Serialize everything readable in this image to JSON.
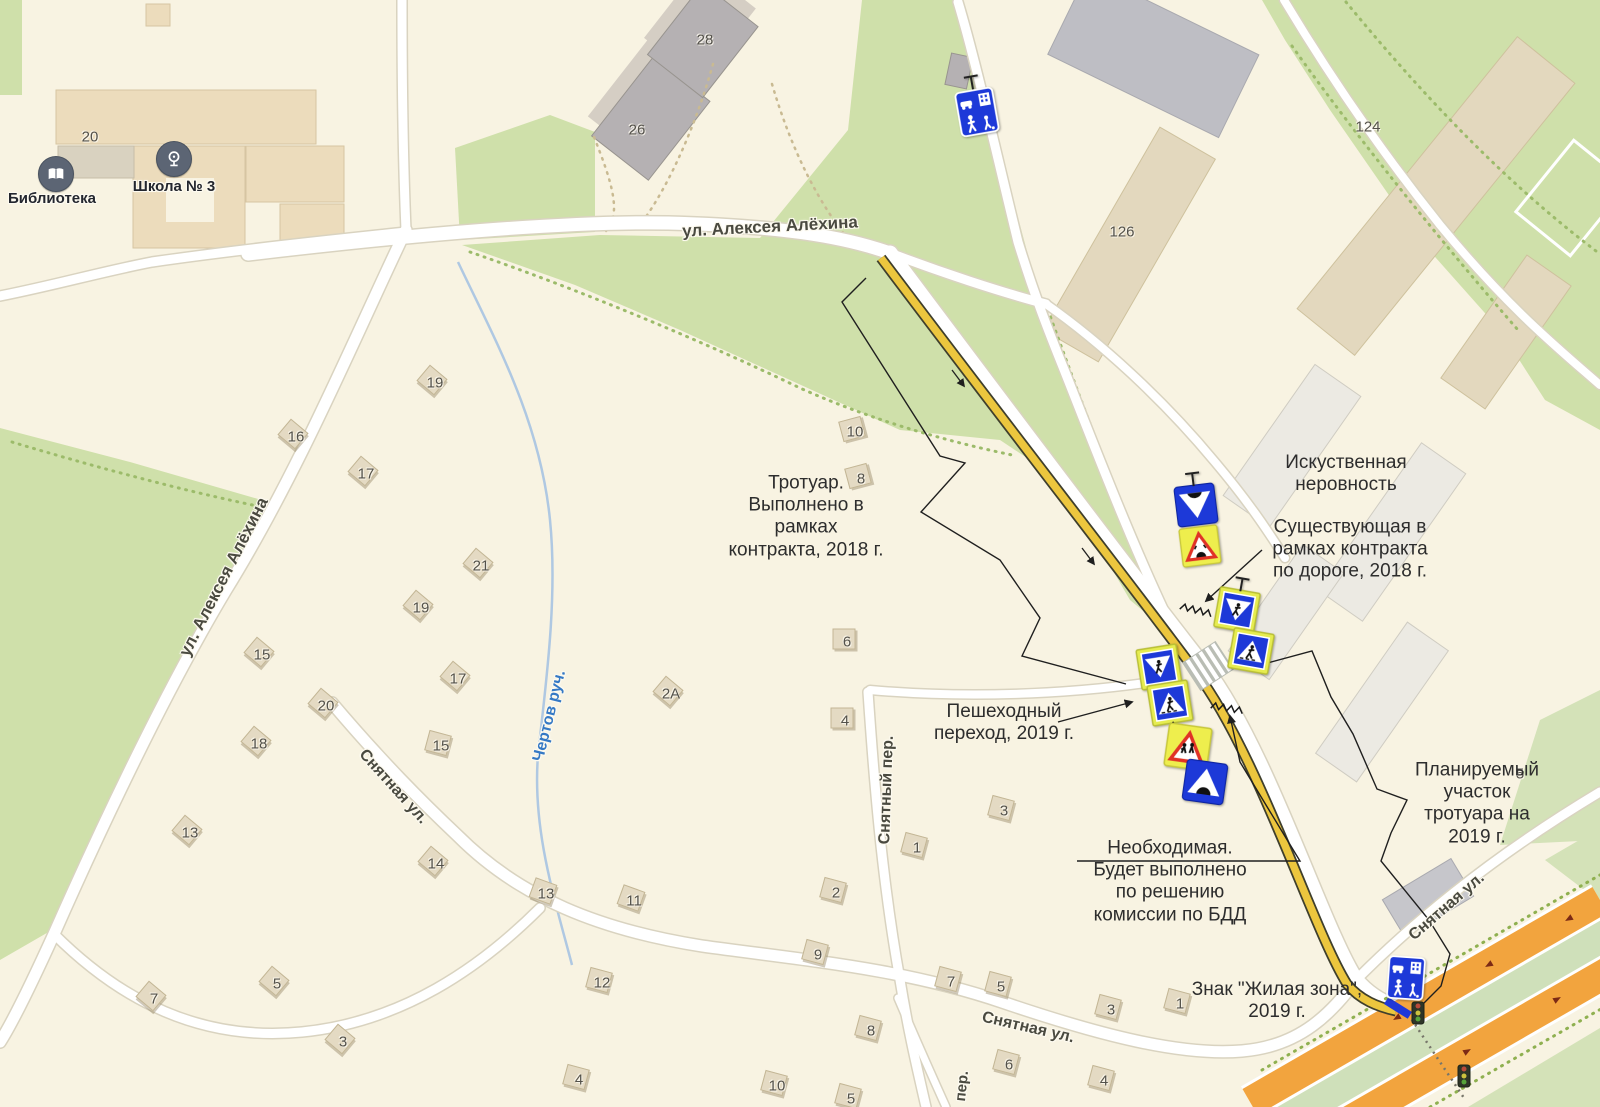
{
  "map": {
    "colors": {
      "background": "#f8f3e2",
      "park_green": "#cfe0aa",
      "road_white": "#ffffff",
      "sidewalk_yellow": "#ecc63e",
      "highway_orange": "#f2a43e",
      "sign_blue": "#1d39d8",
      "sign_frame_yellow": "#e6ec50",
      "warning_yellow": "#eeee4d",
      "warning_red": "#e03226",
      "water_blue": "#3579c5"
    },
    "poi": {
      "library": {
        "label": "Библиотека"
      },
      "school": {
        "label": "Школа № 3"
      }
    },
    "street_labels": [
      {
        "t": "ул. Алексея Алёхина",
        "x": 770,
        "y": 227,
        "r": -3,
        "s": 17
      },
      {
        "t": "ул. Алексея Алёхина",
        "x": 224,
        "y": 577,
        "r": -63,
        "s": 17
      },
      {
        "t": "Снятная ул.",
        "x": 393,
        "y": 787,
        "r": 48,
        "s": 16
      },
      {
        "t": "Снятный пер.",
        "x": 887,
        "y": 790,
        "r": -88,
        "s": 16
      },
      {
        "t": "Снятная ул.",
        "x": 1028,
        "y": 1028,
        "r": 13,
        "s": 16
      },
      {
        "t": "Снятная ул.",
        "x": 1447,
        "y": 907,
        "r": -41,
        "s": 16
      },
      {
        "t": "Чертов руч.",
        "x": 550,
        "y": 716,
        "r": -76,
        "s": 16,
        "c": "#3579c5"
      },
      {
        "t": "пер.",
        "x": 962,
        "y": 1086,
        "r": -84,
        "s": 15
      }
    ],
    "building_numbers": [
      {
        "n": "20",
        "x": 90,
        "y": 137,
        "house": false,
        "rot": 0
      },
      {
        "n": "28",
        "x": 705,
        "y": 40,
        "house": false,
        "rot": 0
      },
      {
        "n": "26",
        "x": 637,
        "y": 130,
        "house": false,
        "rot": 0
      },
      {
        "n": "124",
        "x": 1368,
        "y": 127,
        "house": false,
        "rot": 0
      },
      {
        "n": "126",
        "x": 1122,
        "y": 232,
        "house": false,
        "rot": 0
      },
      {
        "n": "5",
        "x": 1520,
        "y": 774,
        "house": false,
        "rot": 0
      },
      {
        "n": "19",
        "x": 435,
        "y": 383,
        "house": true,
        "rot": 40
      },
      {
        "n": "16",
        "x": 296,
        "y": 437,
        "house": true,
        "rot": 40
      },
      {
        "n": "17",
        "x": 366,
        "y": 474,
        "house": true,
        "rot": 40
      },
      {
        "n": "10",
        "x": 855,
        "y": 432,
        "house": true,
        "rot": -15
      },
      {
        "n": "8",
        "x": 861,
        "y": 479,
        "house": true,
        "rot": -15
      },
      {
        "n": "21",
        "x": 481,
        "y": 566,
        "house": true,
        "rot": 40
      },
      {
        "n": "19",
        "x": 421,
        "y": 608,
        "house": true,
        "rot": 40
      },
      {
        "n": "15",
        "x": 262,
        "y": 655,
        "house": true,
        "rot": 40
      },
      {
        "n": "17",
        "x": 458,
        "y": 679,
        "house": true,
        "rot": 40
      },
      {
        "n": "6",
        "x": 847,
        "y": 642,
        "house": true,
        "rot": 0
      },
      {
        "n": "20",
        "x": 326,
        "y": 706,
        "house": true,
        "rot": 40
      },
      {
        "n": "2А",
        "x": 671,
        "y": 694,
        "house": true,
        "rot": 40
      },
      {
        "n": "4",
        "x": 845,
        "y": 721,
        "house": true,
        "rot": 0
      },
      {
        "n": "15",
        "x": 441,
        "y": 746,
        "house": true,
        "rot": 15
      },
      {
        "n": "18",
        "x": 259,
        "y": 744,
        "house": true,
        "rot": 40
      },
      {
        "n": "13",
        "x": 190,
        "y": 833,
        "house": true,
        "rot": 40
      },
      {
        "n": "3",
        "x": 1004,
        "y": 811,
        "house": true,
        "rot": 15
      },
      {
        "n": "14",
        "x": 436,
        "y": 864,
        "house": true,
        "rot": 40
      },
      {
        "n": "1",
        "x": 917,
        "y": 848,
        "house": true,
        "rot": 15
      },
      {
        "n": "13",
        "x": 546,
        "y": 894,
        "house": true,
        "rot": 20
      },
      {
        "n": "11",
        "x": 634,
        "y": 901,
        "house": true,
        "rot": 20
      },
      {
        "n": "2",
        "x": 836,
        "y": 893,
        "house": true,
        "rot": 15
      },
      {
        "n": "12",
        "x": 602,
        "y": 983,
        "house": true,
        "rot": 15
      },
      {
        "n": "9",
        "x": 818,
        "y": 955,
        "house": true,
        "rot": 15
      },
      {
        "n": "7",
        "x": 154,
        "y": 999,
        "house": true,
        "rot": 40
      },
      {
        "n": "5",
        "x": 277,
        "y": 984,
        "house": true,
        "rot": 40
      },
      {
        "n": "7",
        "x": 951,
        "y": 982,
        "house": true,
        "rot": 15
      },
      {
        "n": "5",
        "x": 1001,
        "y": 987,
        "house": true,
        "rot": 15
      },
      {
        "n": "1",
        "x": 1180,
        "y": 1004,
        "house": true,
        "rot": 15
      },
      {
        "n": "3",
        "x": 343,
        "y": 1042,
        "house": true,
        "rot": 40
      },
      {
        "n": "3",
        "x": 1111,
        "y": 1010,
        "house": true,
        "rot": 15
      },
      {
        "n": "4",
        "x": 579,
        "y": 1080,
        "house": true,
        "rot": 15
      },
      {
        "n": "10",
        "x": 777,
        "y": 1086,
        "house": true,
        "rot": 15
      },
      {
        "n": "8",
        "x": 871,
        "y": 1031,
        "house": true,
        "rot": 15
      },
      {
        "n": "6",
        "x": 1009,
        "y": 1065,
        "house": true,
        "rot": 15
      },
      {
        "n": "5",
        "x": 851,
        "y": 1099,
        "house": true,
        "rot": 15
      },
      {
        "n": "4",
        "x": 1104,
        "y": 1081,
        "house": true,
        "rot": 15
      }
    ],
    "annotations": [
      {
        "x": 806,
        "y": 517,
        "text": "Тротуар.\nВыполнено в\nрамках\nконтракта, 2018 г."
      },
      {
        "x": 1346,
        "y": 474,
        "text": "Искуственная\nнеровность"
      },
      {
        "x": 1350,
        "y": 550,
        "text": "Существующая в\nрамках контракта\nпо дороге, 2018 г."
      },
      {
        "x": 1004,
        "y": 723,
        "text": "Пешеходный\nпереход, 2019 г."
      },
      {
        "x": 1170,
        "y": 882,
        "text": "Необходимая.\nБудет выполнено\nпо решению\nкомиссии по БДД"
      },
      {
        "x": 1477,
        "y": 804,
        "text": "Планируемый\nучасток\nтротуара на\n2019 г."
      },
      {
        "x": 1277,
        "y": 1001,
        "text": "Знак \"Жилая зона\",\n2019 г."
      }
    ],
    "signs": [
      {
        "type": "residential-zone",
        "x": 977,
        "y": 112,
        "w": 40,
        "h": 50,
        "rot": -10,
        "pole": "top"
      },
      {
        "type": "speed-bump-down",
        "x": 1196,
        "y": 505,
        "w": 46,
        "h": 42,
        "rot": -7,
        "pole": "top"
      },
      {
        "type": "bump-warning",
        "x": 1200,
        "y": 546,
        "w": 44,
        "h": 40,
        "rot": -7
      },
      {
        "type": "crosswalk-down",
        "x": 1237,
        "y": 610,
        "w": 44,
        "h": 42,
        "rot": 10,
        "pole": "top"
      },
      {
        "type": "crosswalk-up",
        "x": 1251,
        "y": 651,
        "w": 44,
        "h": 42,
        "rot": 10
      },
      {
        "type": "crosswalk-down",
        "x": 1159,
        "y": 667,
        "w": 44,
        "h": 42,
        "rot": -9
      },
      {
        "type": "crosswalk-up",
        "x": 1170,
        "y": 703,
        "w": 44,
        "h": 42,
        "rot": -9,
        "pole": "bottom"
      },
      {
        "type": "children-warning",
        "x": 1188,
        "y": 747,
        "w": 48,
        "h": 45,
        "rot": 8
      },
      {
        "type": "speed-bump-up",
        "x": 1205,
        "y": 782,
        "w": 46,
        "h": 43,
        "rot": 8
      },
      {
        "type": "residential-zone",
        "x": 1406,
        "y": 978,
        "w": 38,
        "h": 47,
        "rot": 4
      }
    ],
    "traffic_lights": [
      {
        "x": 1418,
        "y": 1013
      },
      {
        "x": 1464,
        "y": 1076
      }
    ]
  }
}
